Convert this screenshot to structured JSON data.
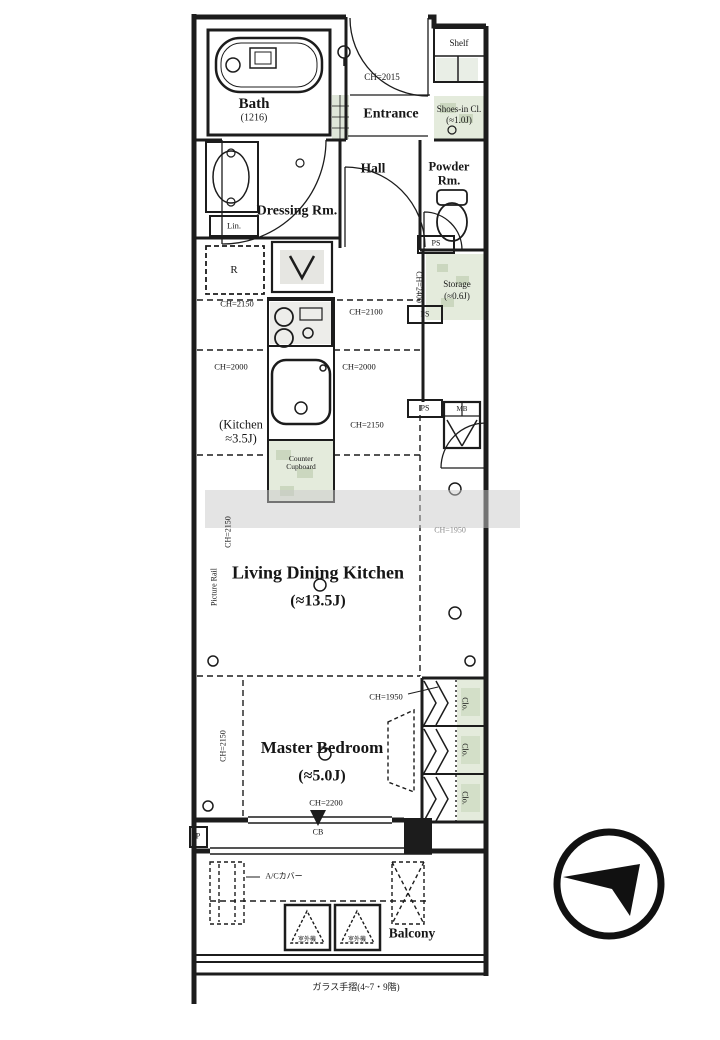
{
  "plan": {
    "rooms": {
      "bath": {
        "name": "Bath",
        "size": "(1216)"
      },
      "entrance": {
        "name": "Entrance"
      },
      "shelf": {
        "name": "Shelf"
      },
      "shoes_closet": {
        "name": "Shoes-in Cl.",
        "size": "(≈1.0J)"
      },
      "dressing": {
        "name": "Dressing Rm."
      },
      "hall": {
        "name": "Hall"
      },
      "powder": {
        "name": "Powder Rm."
      },
      "storage": {
        "name": "Storage",
        "size": "(≈0.6J)"
      },
      "kitchen": {
        "name": "(Kitchen",
        "size": "≈3.5J)"
      },
      "ldk": {
        "name": "Living Dining Kitchen",
        "size": "(≈13.5J)"
      },
      "master_bedroom": {
        "name": "Master Bedroom",
        "size": "(≈5.0J)"
      },
      "balcony": {
        "name": "Balcony"
      }
    },
    "fixtures": {
      "linen": "Lin.",
      "refrigerator": "R",
      "pipe_space": "PS",
      "meter_box": "MB",
      "closet": "Clo.",
      "pole": "P",
      "crossbeam": "CB",
      "counter_cupboard": "Counter Cupboard",
      "picture_rail": "Picture Rail",
      "ac_cover": "A/Cカバー",
      "outdoor_unit": "室外機",
      "glass_handrail": "ガラス手摺(4~7・9階)"
    },
    "ceiling_heights": {
      "entrance": "CH=2015",
      "kitchen_nw": "CH=2150",
      "hall_side": "CH=2100",
      "kitchen_w": "CH=2000",
      "kitchen_e": "CH=2000",
      "kitchen_s": "CH=2150",
      "storage": "CH=2400",
      "ldk_east": "CH=1950",
      "ldk_west": "CH=2150",
      "bedroom_n": "CH=1950",
      "bedroom_w": "CH=2150",
      "bedroom_s": "CH=2200"
    },
    "colors": {
      "line": "#1c1c1c",
      "tint_green": "#e4ebdc",
      "tint_gray": "#ededea",
      "watermark": "#c9c9c9"
    }
  }
}
